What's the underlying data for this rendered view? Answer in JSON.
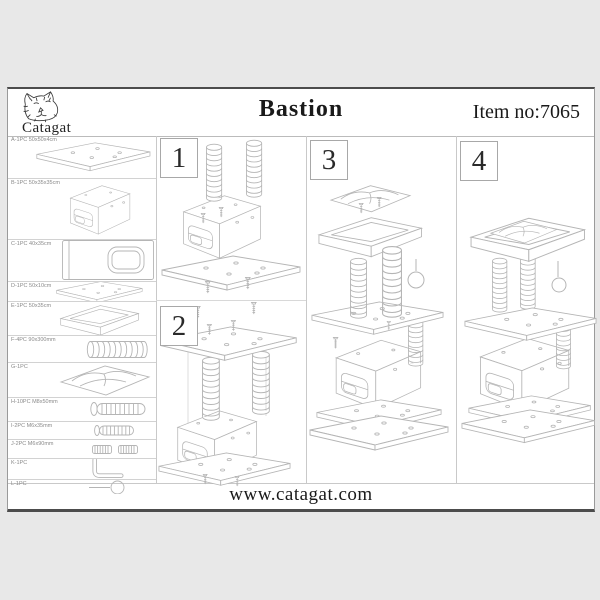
{
  "header": {
    "brand": "Catagat",
    "title": "Bastion",
    "item_no": "Item no:7065"
  },
  "steps": [
    {
      "number": "1"
    },
    {
      "number": "2"
    },
    {
      "number": "3"
    },
    {
      "number": "4"
    }
  ],
  "parts": [
    {
      "id": "A",
      "label": "A-1PC 50x50x4cm",
      "name": "base-board"
    },
    {
      "id": "B",
      "label": "B-1PC 50x35x35cm",
      "name": "house-box"
    },
    {
      "id": "C",
      "label": "C-1PC 40x35cm",
      "name": "panel-with-hole"
    },
    {
      "id": "D",
      "label": "D-1PC 50x10cm",
      "name": "middle-board"
    },
    {
      "id": "E",
      "label": "E-1PC 50x35cm",
      "name": "bed-tray"
    },
    {
      "id": "F",
      "label": "F-4PC 90x300mm",
      "name": "scratching-post"
    },
    {
      "id": "G",
      "label": "G-1PC",
      "name": "cushion"
    },
    {
      "id": "H",
      "label": "H-10PC M8x50mm",
      "name": "large-bolt"
    },
    {
      "id": "I",
      "label": "I-2PC M6x35mm",
      "name": "medium-bolt"
    },
    {
      "id": "J",
      "label": "J-2PC M6x90mm",
      "name": "connector-bolts"
    },
    {
      "id": "K",
      "label": "K-1PC",
      "name": "allen-key"
    },
    {
      "id": "L",
      "label": "L-1PC",
      "name": "ball-toy"
    }
  ],
  "footer": {
    "website": "www.catagat.com"
  },
  "colors": {
    "canvas": "#e8e8e8",
    "page": "#ffffff",
    "page_border": "#4c4c4c",
    "grid_line": "#cccccc",
    "drawing_line": "#b5b5b5",
    "text": "#1a1a1a"
  }
}
